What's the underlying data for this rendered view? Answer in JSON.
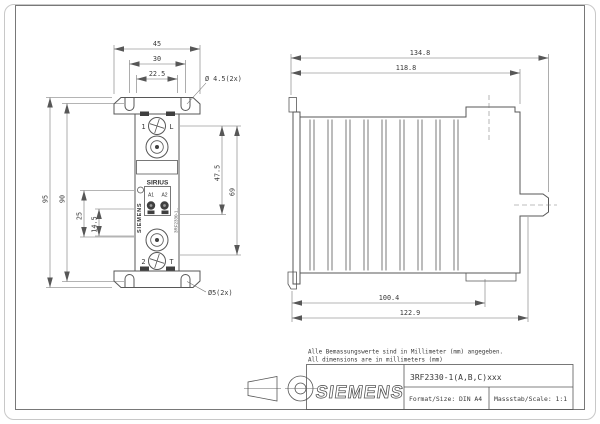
{
  "notes": {
    "line1": "Alle Bemassungswerte sind in Millimeter (mm) angegeben.",
    "line2": "All dimensions are in millimeters (mm)"
  },
  "title_block": {
    "brand": "SIEMENS",
    "part_number": "3RF2330-1(A,B,C)xxx",
    "format": "Format/Size: DIN A4",
    "scale": "Massstab/Scale: 1:1"
  },
  "front_view": {
    "dims": {
      "width_outer": "45",
      "width_slots": "30",
      "width_body": "22.5",
      "top_hole": "Ø 4.5(2x)",
      "height_outer": "95",
      "height_slots": "90",
      "left_inner": "25",
      "left_inner2": "14.5",
      "right_inner": "47.5",
      "right_outer": "69",
      "bottom_hole": "Ø5(2x)"
    },
    "labels": {
      "terminal1_no": "1",
      "terminal1_id": "L",
      "terminal2_no": "2",
      "terminal2_id": "T",
      "product_line": "SIRIUS",
      "coil_a1": "A1",
      "coil_a2": "A2",
      "brand_vertical": "SIEMENS",
      "model_vertical": "3RF2330-1.."
    }
  },
  "side_view": {
    "dims": {
      "depth_total": "134.8",
      "depth_body": "118.8",
      "depth_heatsink": "100.4",
      "depth_clip": "122.9"
    }
  }
}
